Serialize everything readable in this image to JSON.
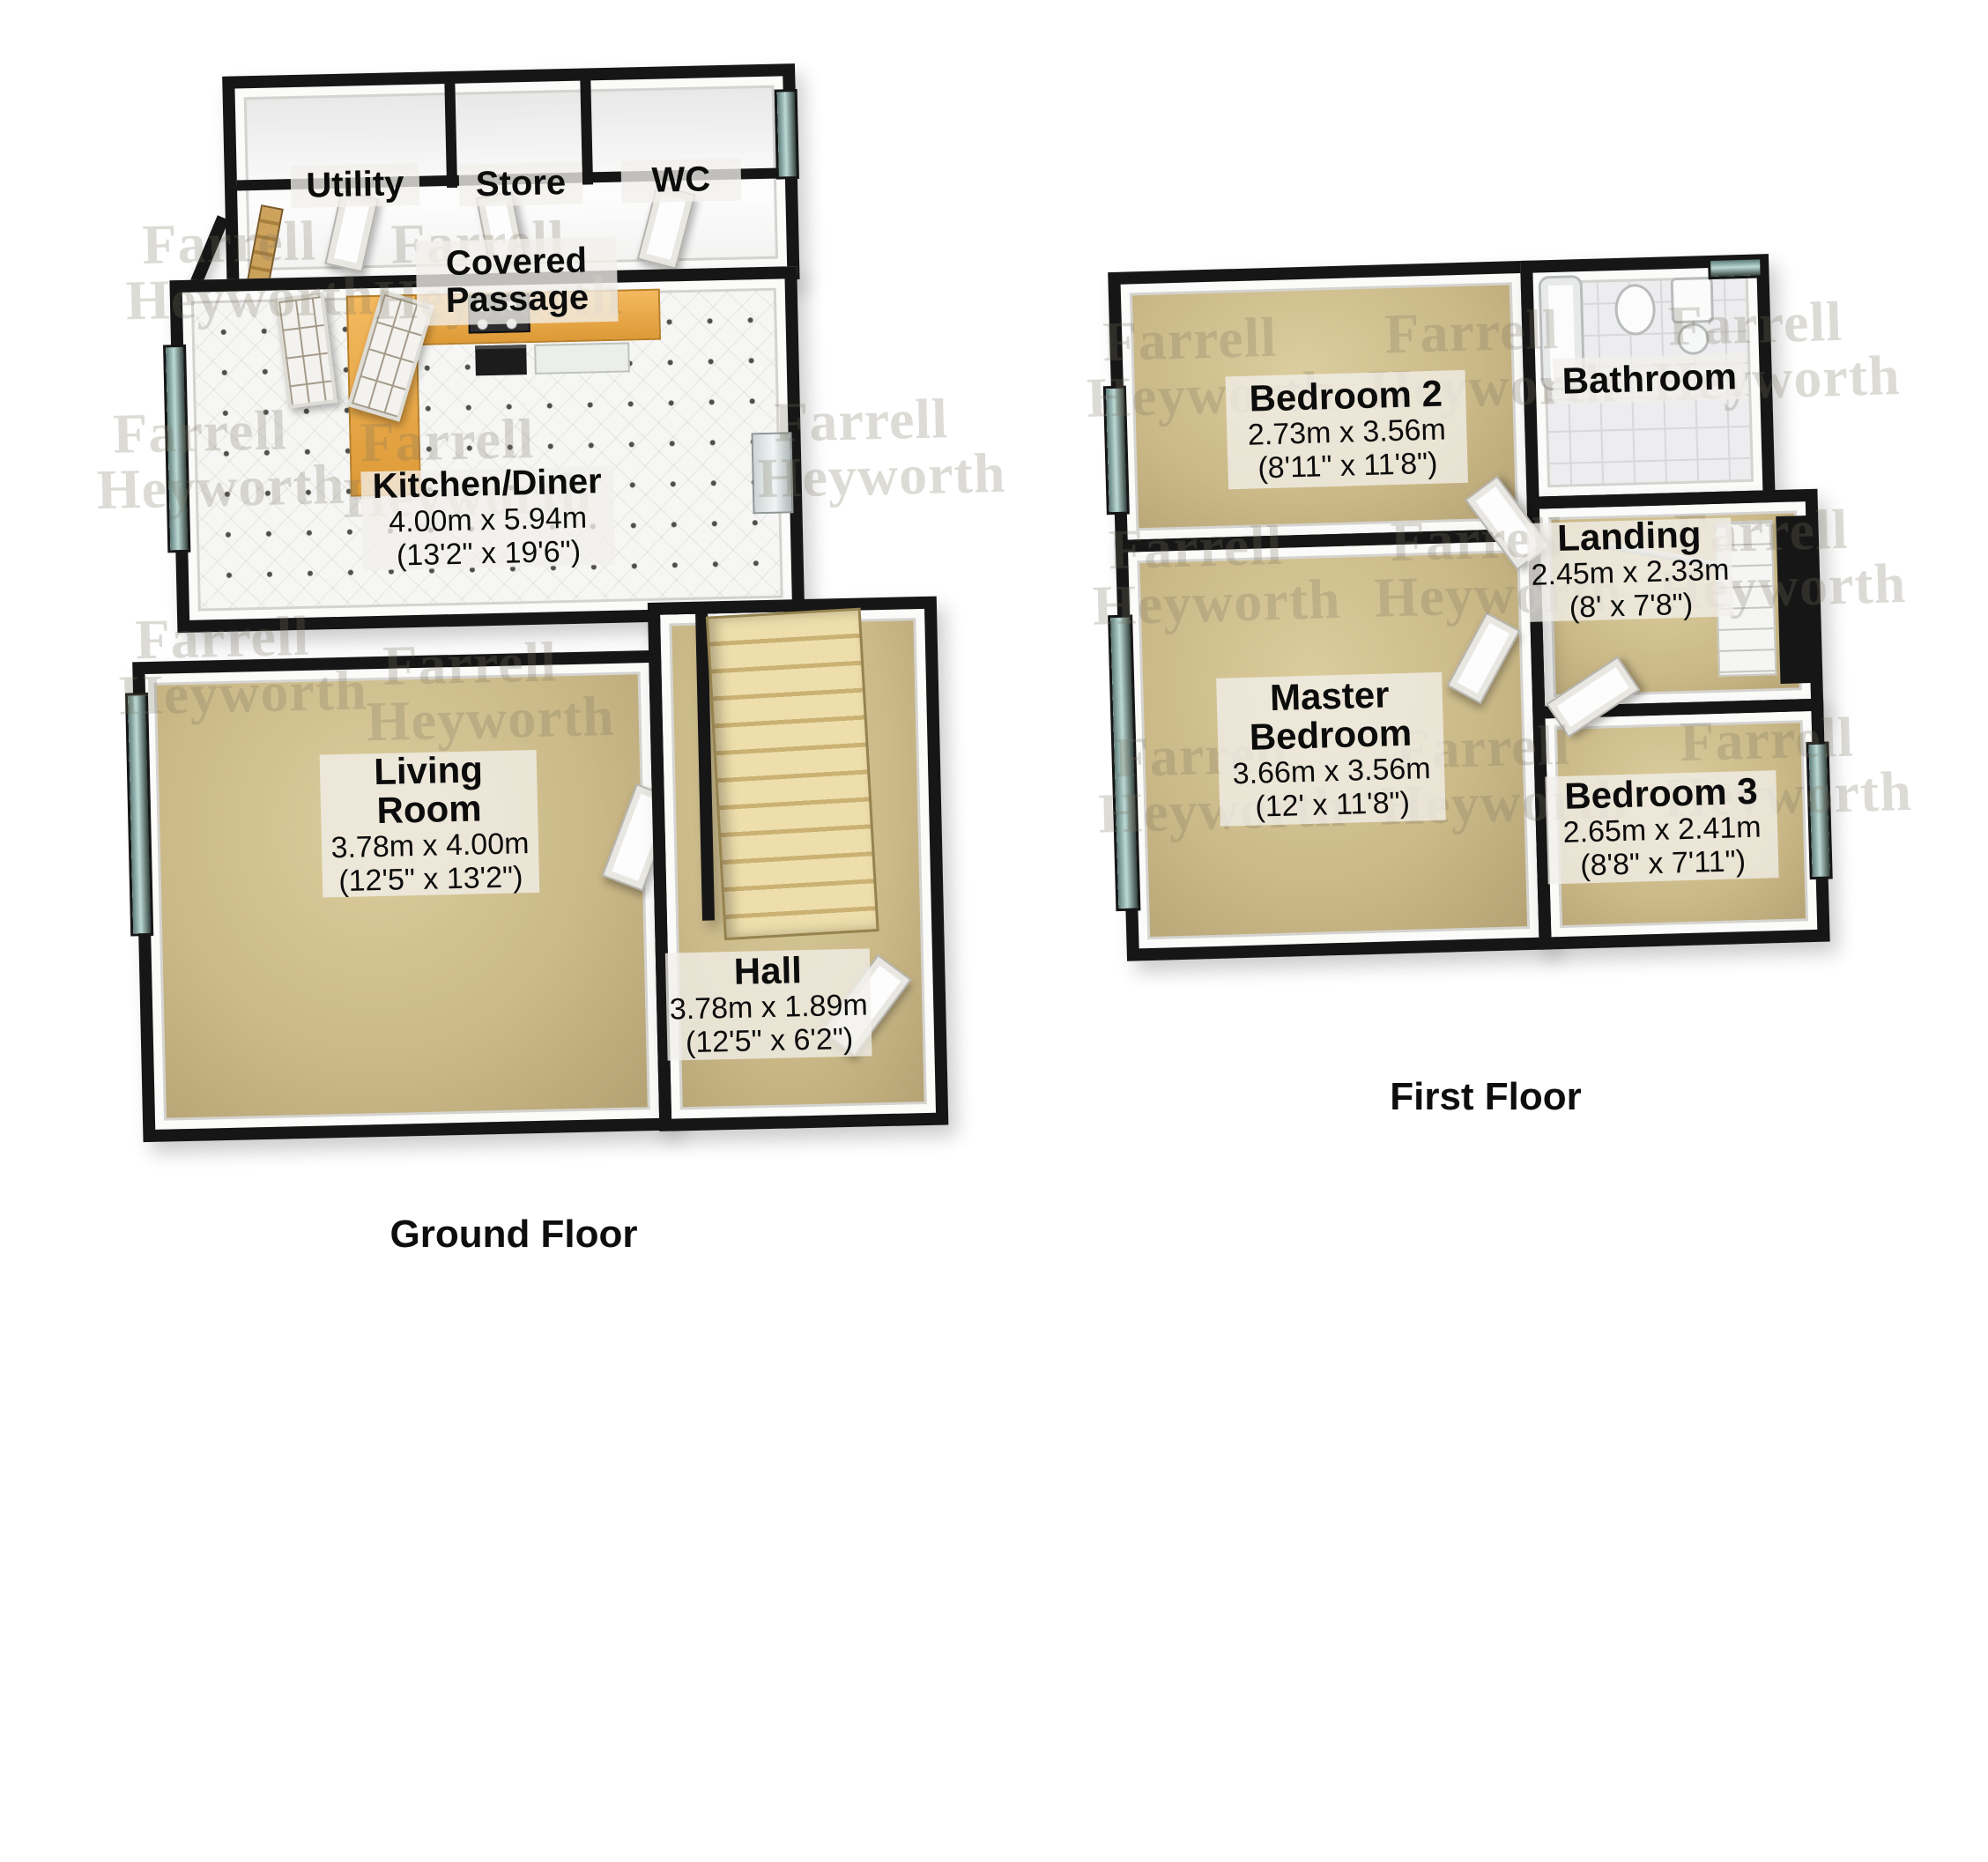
{
  "watermark": {
    "line1": "Farrell",
    "line2": "Heyworth"
  },
  "ground_floor": {
    "caption": "Ground Floor",
    "rooms": [
      {
        "id": "utility",
        "name": "Utility"
      },
      {
        "id": "store",
        "name": "Store"
      },
      {
        "id": "wc",
        "name": "WC"
      },
      {
        "id": "covered-passage",
        "name": "Covered Passage"
      },
      {
        "id": "kitchen-diner",
        "name": "Kitchen/Diner",
        "metric": "4.00m x 5.94m",
        "imperial": "(13'2\" x 19'6\")"
      },
      {
        "id": "living-room",
        "name": "Living Room",
        "metric": "3.78m x 4.00m",
        "imperial": "(12'5\" x 13'2\")"
      },
      {
        "id": "hall",
        "name": "Hall",
        "metric": "3.78m x 1.89m",
        "imperial": "(12'5\" x 6'2\")"
      }
    ]
  },
  "first_floor": {
    "caption": "First Floor",
    "rooms": [
      {
        "id": "bedroom-2",
        "name": "Bedroom 2",
        "metric": "2.73m x 3.56m",
        "imperial": "(8'11\" x 11'8\")"
      },
      {
        "id": "bathroom",
        "name": "Bathroom"
      },
      {
        "id": "landing",
        "name": "Landing",
        "metric": "2.45m x 2.33m",
        "imperial": "(8' x 7'8\")"
      },
      {
        "id": "master-bedroom",
        "name": "Master Bedroom",
        "metric": "3.66m x 3.56m",
        "imperial": "(12' x 11'8\")"
      },
      {
        "id": "bedroom-3",
        "name": "Bedroom 3",
        "metric": "2.65m x 2.41m",
        "imperial": "(8'8\" x 7'11\")"
      }
    ]
  },
  "colors": {
    "wall": "#161616",
    "carpet": "#cbb988",
    "kitchen_tile": "#f6f6f4",
    "counter": "#e9a74b",
    "stairs": "#e7d6a3",
    "window_glass": "#8fb7b1",
    "label_bg": "#f0eee8",
    "watermark": "#8c8273"
  }
}
